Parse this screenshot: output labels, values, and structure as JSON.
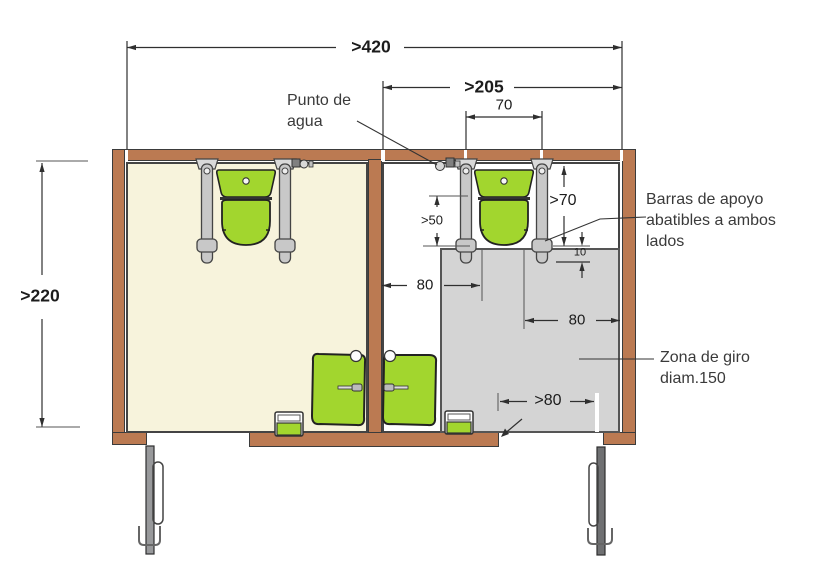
{
  "figure": {
    "type": "floor-plan",
    "description": "Planta de aseos accesibles con dos cabinas, cotas en cm"
  },
  "dimensions": {
    "total_width": ">420",
    "accessible_cabin_width": ">205",
    "grab_bar_spacing": "70",
    "total_depth": ">220",
    "toilet_front_depth": ">50",
    "grab_bar_length": ">70",
    "bar_zone_gap": "10",
    "transfer_left": "80",
    "transfer_right": "80",
    "door_clear_width": ">80"
  },
  "labels": {
    "water_point": "Punto de agua",
    "grab_bars": "Barras de apoyo abatibles a ambos lados",
    "turning_zone": "Zona de giro diam.150"
  },
  "colors": {
    "wall": "#bb7a52",
    "left_floor": "#f7f3dc",
    "right_floor": "#ffffff",
    "turning_zone": "#d4d4d4",
    "fixture_green": "#a2d62e",
    "grab_bar": "#c8c8c8",
    "door_left": "#98999b",
    "door_right": "#6f7072"
  }
}
